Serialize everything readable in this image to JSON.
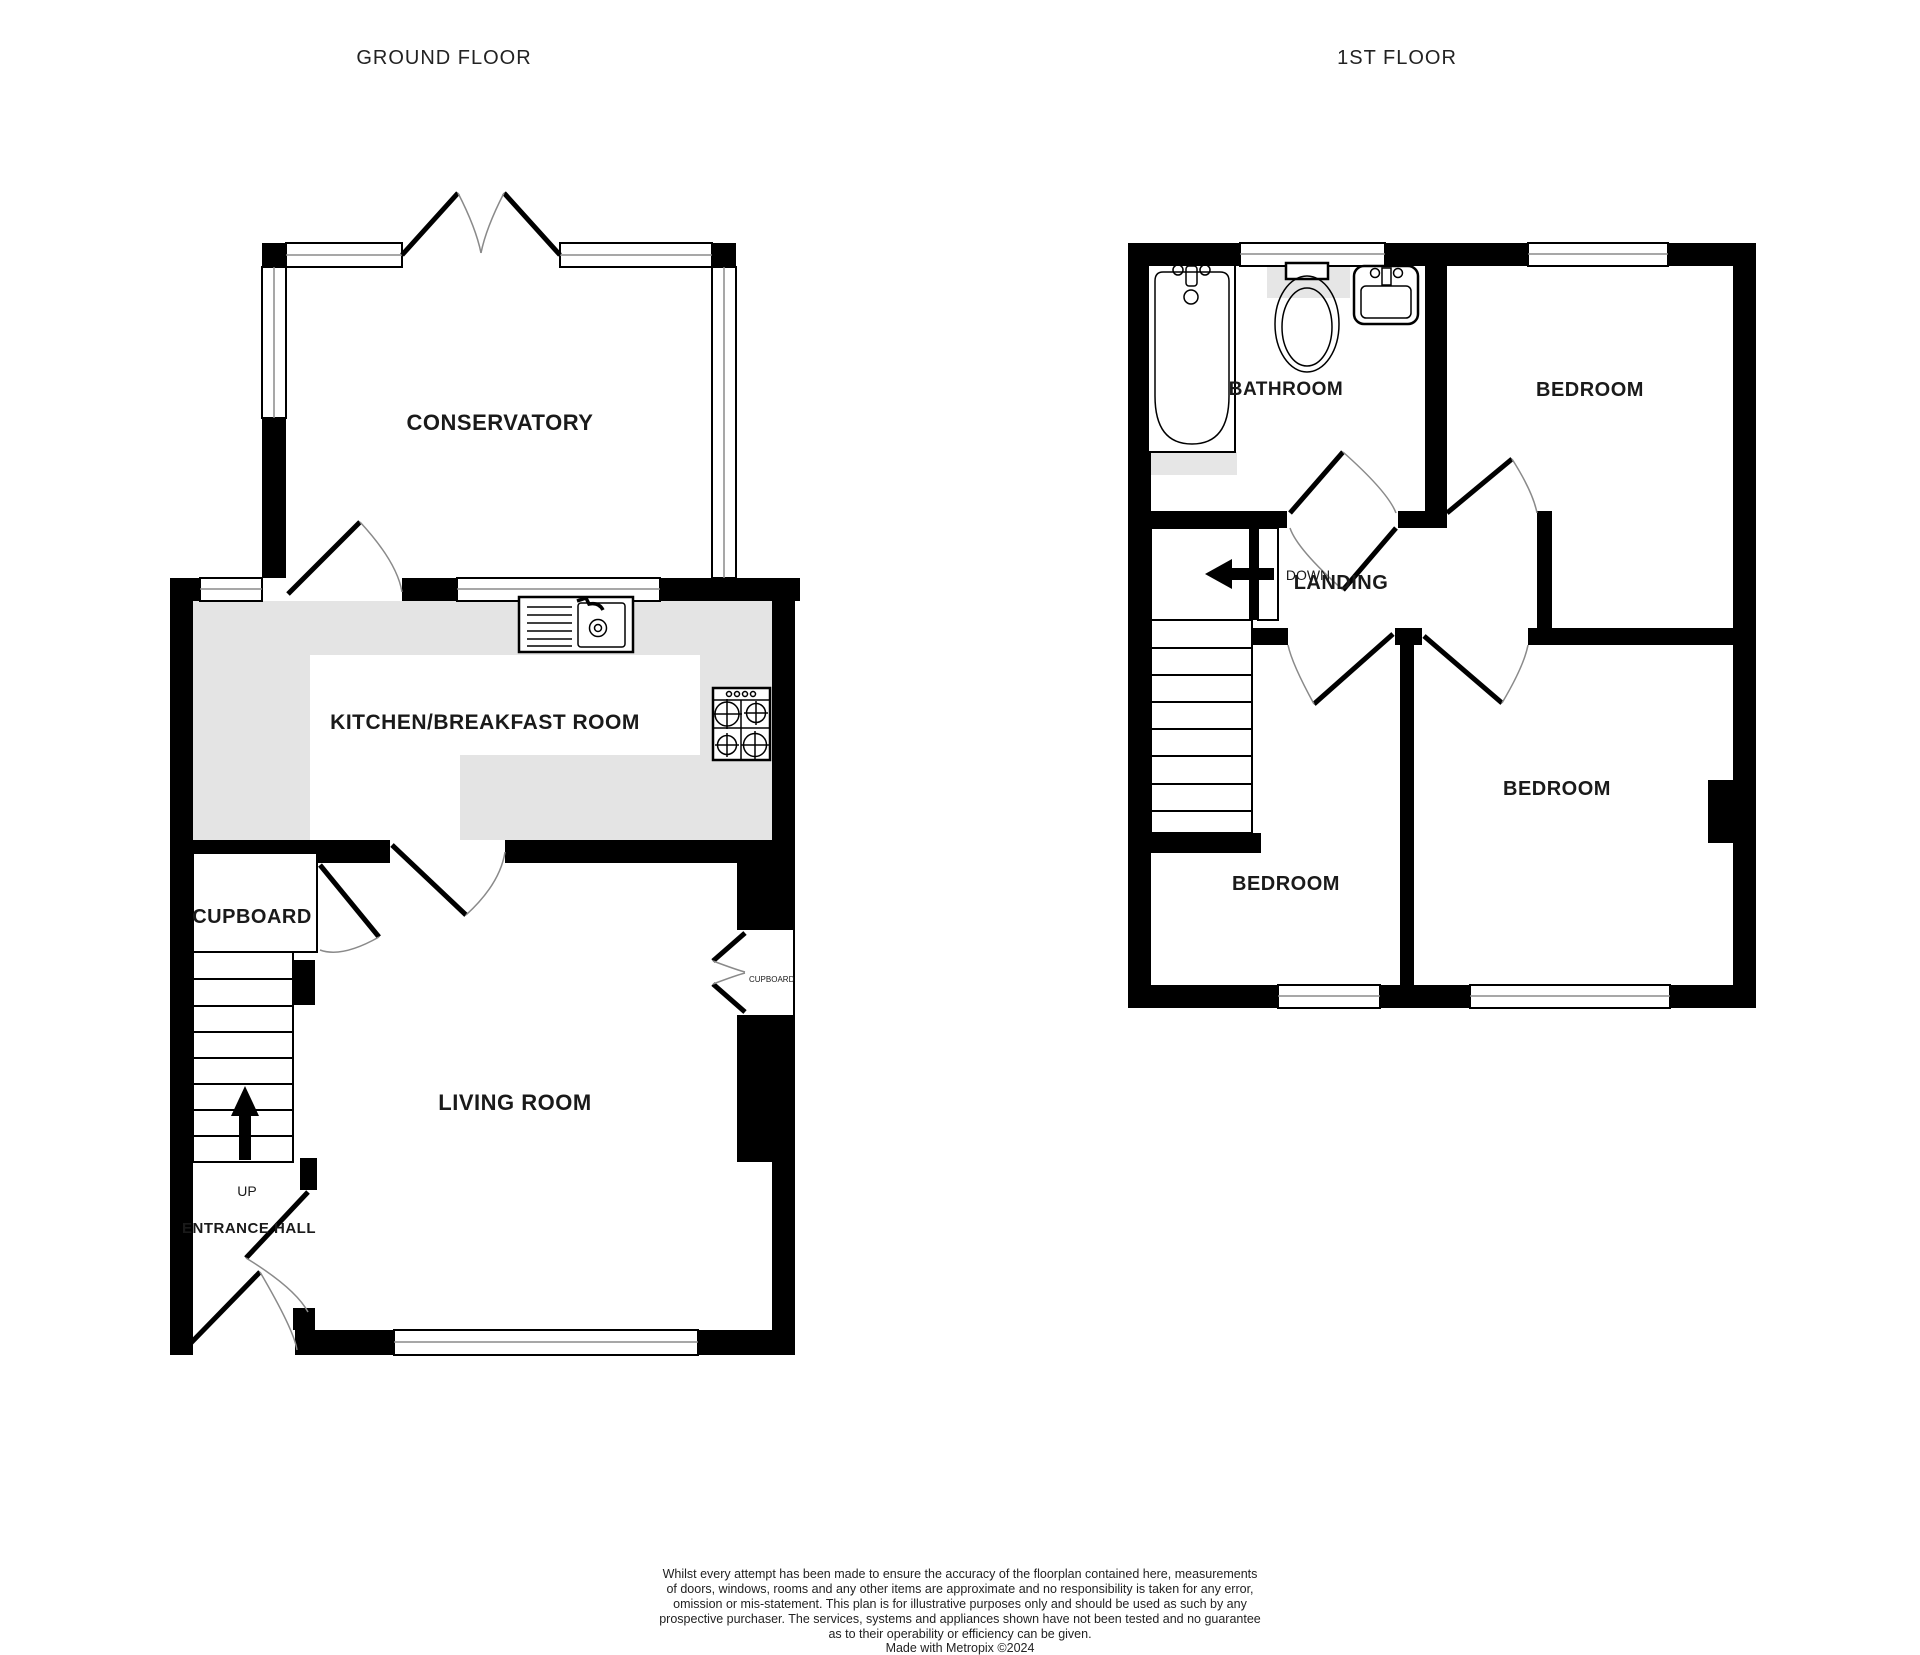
{
  "page": {
    "width": 1920,
    "height": 1655,
    "background": "#ffffff"
  },
  "titles": {
    "ground_floor": "GROUND FLOOR",
    "first_floor": "1ST FLOOR"
  },
  "ground_floor": {
    "conservatory_label": "CONSERVATORY",
    "kitchen_label": "KITCHEN/BREAKFAST ROOM",
    "cupboard_label": "CUPBOARD",
    "living_room_label": "LIVING ROOM",
    "entrance_hall_label": "ENTRANCE HALL",
    "up_label": "UP",
    "alcove_cupboard_label": "CUPBOARD"
  },
  "first_floor": {
    "bathroom_label": "BATHROOM",
    "bedroom_front_label": "BEDROOM",
    "bedroom_rear_right_label": "BEDROOM",
    "bedroom_rear_left_label": "BEDROOM",
    "landing_label": "LANDING",
    "down_label": "DOWN"
  },
  "icons": {
    "up_arrow": "stairs-up-arrow",
    "down_arrow": "stairs-down-arrow",
    "bathtub": "bathtub-plan-symbol",
    "toilet": "toilet-plan-symbol",
    "wash_basin": "wash-basin-plan-symbol",
    "kitchen_sink": "sink-with-drainer-symbol",
    "hob": "four-burner-hob-symbol"
  },
  "disclaimer": {
    "lines": [
      "Whilst every attempt has been made to ensure the accuracy of the floorplan contained here, measurements",
      "of doors, windows, rooms and any other items are approximate and no responsibility is taken for any error,",
      "omission or mis-statement. This plan is for illustrative purposes only and should be used as such by any",
      "prospective purchaser. The services, systems and appliances shown have not been tested and no guarantee",
      "as to their operability or efficiency can be given.",
      "Made with Metropix ©2024"
    ]
  },
  "colors": {
    "wall": "#000000",
    "counter": "#e4e4e4",
    "fixture_shadow": "#e6e6e6",
    "window_line": "#8a8a8a",
    "text": "#1a1a1a"
  }
}
